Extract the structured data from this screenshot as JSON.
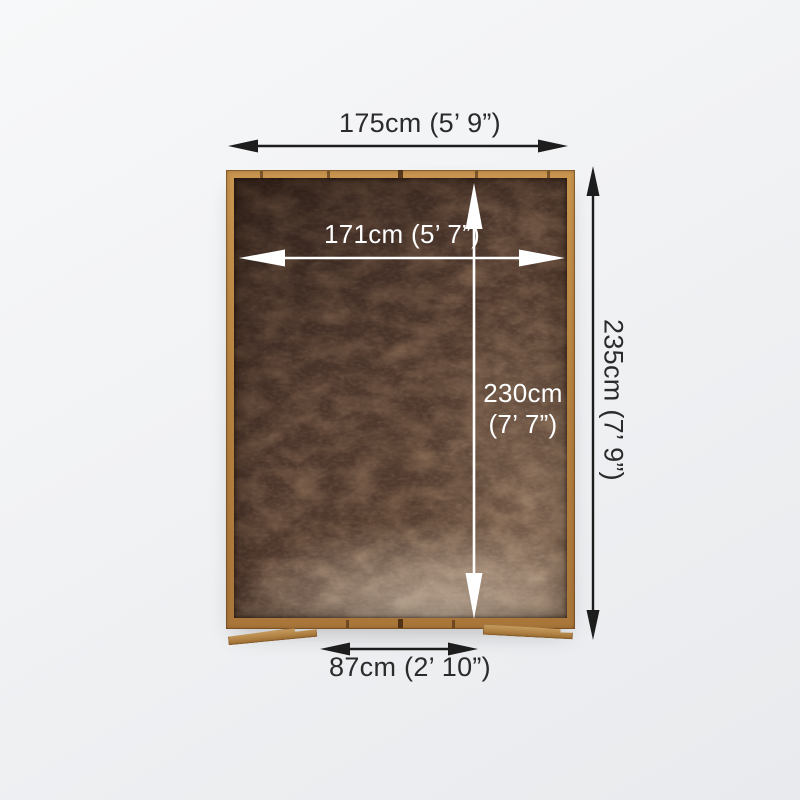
{
  "dimensions": {
    "external_width": "175cm (5’ 9”)",
    "internal_width": "171cm (5’ 7”)",
    "internal_depth_line1": "230cm",
    "internal_depth_line2": "(7’ 7”)",
    "external_depth": "235cm (7’ 9”)",
    "door_width": "87cm (2’ 10”)"
  },
  "colors": {
    "arrow_dark": "#1d1d1d",
    "arrow_light": "#ffffff",
    "frame_wood": "#b5813f",
    "floor_dark": "#4c362b",
    "floor_highlight": "#c3ab94",
    "background": "#f0f1f3",
    "label_text": "#2b2b2b"
  }
}
